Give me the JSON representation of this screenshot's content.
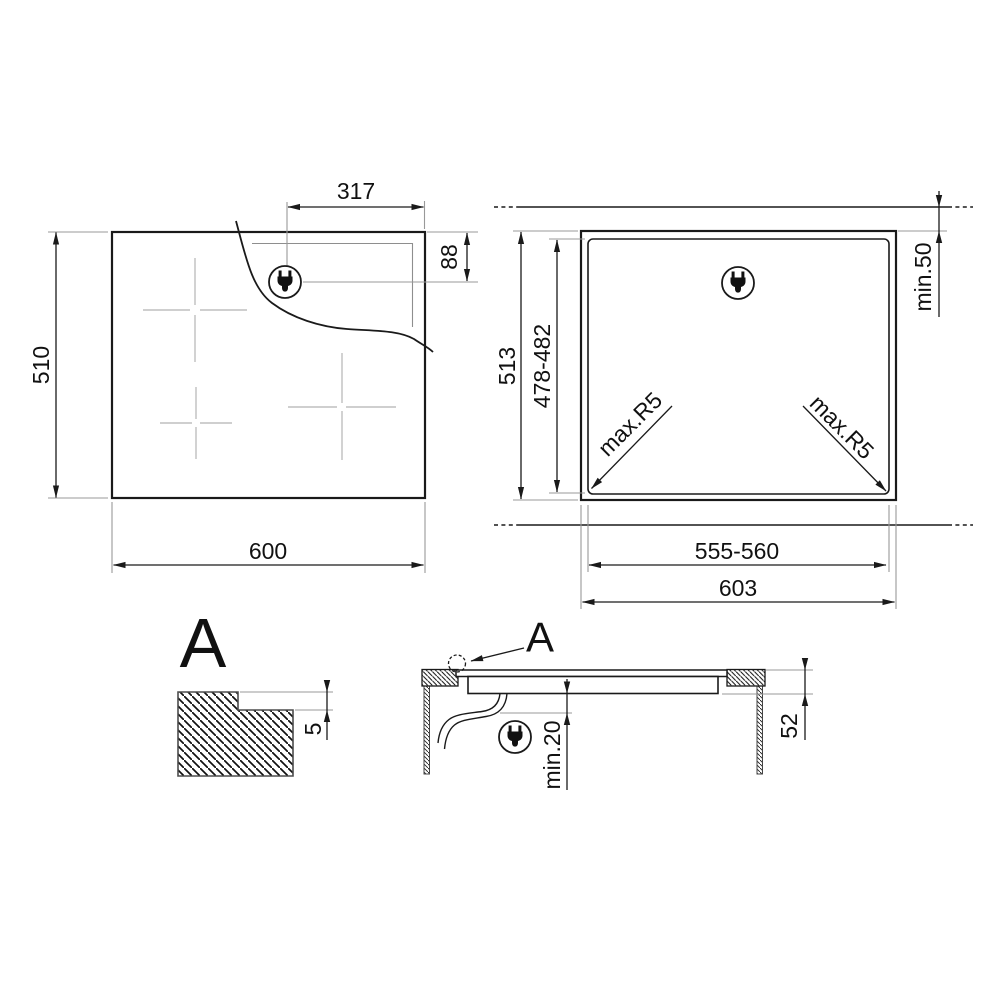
{
  "figures": {
    "hob_top_view": {
      "description_icons": {
        "plug_icon": "power-plug",
        "zone_marker_icon": "cross-centerline"
      },
      "width_mm": "600",
      "depth_mm": "510",
      "plug_offset_from_right_mm": "317",
      "plug_offset_from_top_mm": "88"
    },
    "worktop_cutout_view": {
      "description_icons": {
        "plug_icon": "power-plug"
      },
      "worktop_depth_mm": "513",
      "cutout_depth_mm": "478-482",
      "cutout_width_mm": "555-560",
      "worktop_width_mm": "603",
      "rear_edge_clearance": "min.50",
      "corner_radius_left": "max.R5",
      "corner_radius_right": "max.R5"
    },
    "detail_a_view": {
      "detail_label": "A",
      "rebate_depth_mm": "5"
    },
    "side_section_view": {
      "description_icons": {
        "plug_icon": "power-plug",
        "detail_marker_icon": "dashed-circle"
      },
      "detail_callout_label": "A",
      "underside_clearance": "min.20",
      "installed_height_mm": "52"
    }
  },
  "colors": {
    "drawing_line": "#1a1a1a",
    "extension_line": "#999999",
    "zone_cross": "#bfbfbf",
    "background": "#ffffff"
  }
}
